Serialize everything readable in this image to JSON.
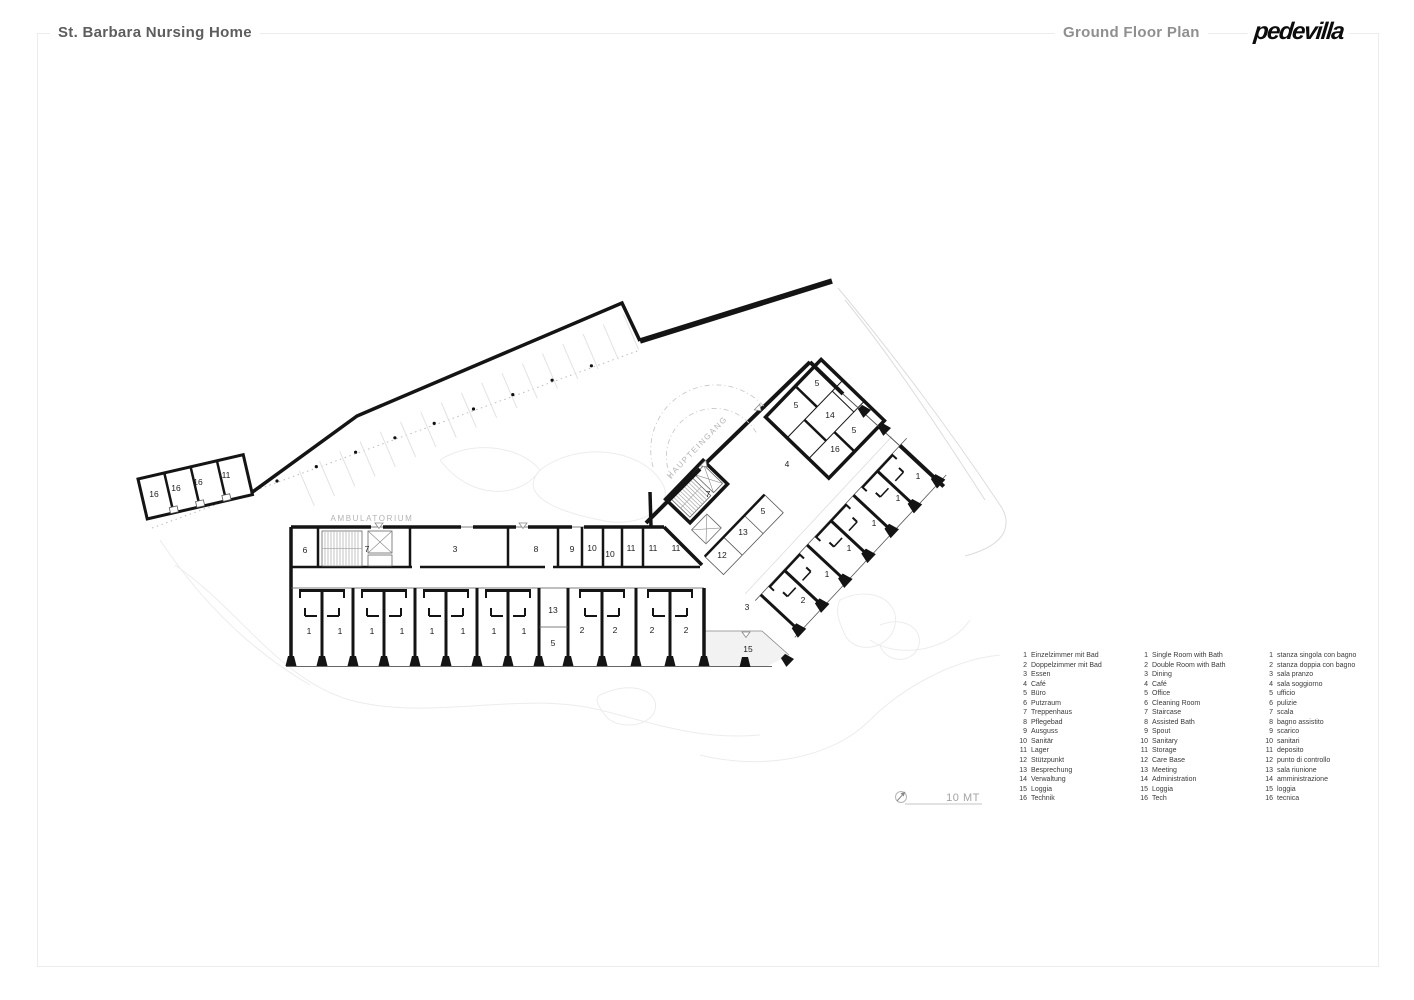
{
  "header": {
    "project_title": "St. Barbara Nursing Home",
    "sheet_title": "Ground Floor Plan",
    "logo_text": "pedevilla"
  },
  "icons": {
    "north_arrow": "compass-north-arrow-icon"
  },
  "colors": {
    "wall": "#141414",
    "annotation_gray": "#b3b3b3",
    "site_gray": "#ececec"
  },
  "plan": {
    "labels": [
      {
        "t": "16",
        "x": 154,
        "y": 497
      },
      {
        "t": "16",
        "x": 176,
        "y": 491
      },
      {
        "t": "16",
        "x": 198,
        "y": 485
      },
      {
        "t": "11",
        "x": 226,
        "y": 478
      },
      {
        "t": "6",
        "x": 305,
        "y": 553
      },
      {
        "t": "7",
        "x": 367,
        "y": 552
      },
      {
        "t": "3",
        "x": 455,
        "y": 552
      },
      {
        "t": "8",
        "x": 536,
        "y": 552
      },
      {
        "t": "9",
        "x": 572,
        "y": 552
      },
      {
        "t": "10",
        "x": 592,
        "y": 551
      },
      {
        "t": "10",
        "x": 610,
        "y": 557
      },
      {
        "t": "11",
        "x": 631,
        "y": 551
      },
      {
        "t": "11",
        "x": 653,
        "y": 551
      },
      {
        "t": "11",
        "x": 676,
        "y": 551
      },
      {
        "t": "7",
        "x": 708,
        "y": 497
      },
      {
        "t": "5",
        "x": 763,
        "y": 514
      },
      {
        "t": "13",
        "x": 743,
        "y": 535
      },
      {
        "t": "12",
        "x": 722,
        "y": 558
      },
      {
        "t": "1",
        "x": 309,
        "y": 634
      },
      {
        "t": "1",
        "x": 340,
        "y": 634
      },
      {
        "t": "1",
        "x": 372,
        "y": 634
      },
      {
        "t": "1",
        "x": 402,
        "y": 634
      },
      {
        "t": "1",
        "x": 432,
        "y": 634
      },
      {
        "t": "1",
        "x": 463,
        "y": 634
      },
      {
        "t": "1",
        "x": 494,
        "y": 634
      },
      {
        "t": "1",
        "x": 524,
        "y": 634
      },
      {
        "t": "13",
        "x": 553,
        "y": 613
      },
      {
        "t": "5",
        "x": 553,
        "y": 646
      },
      {
        "t": "2",
        "x": 582,
        "y": 633
      },
      {
        "t": "2",
        "x": 615,
        "y": 633
      },
      {
        "t": "2",
        "x": 652,
        "y": 633
      },
      {
        "t": "2",
        "x": 686,
        "y": 633
      },
      {
        "t": "3",
        "x": 747,
        "y": 610
      },
      {
        "t": "15",
        "x": 748,
        "y": 652
      },
      {
        "t": "5",
        "x": 817,
        "y": 386
      },
      {
        "t": "5",
        "x": 796,
        "y": 408
      },
      {
        "t": "14",
        "x": 830,
        "y": 418
      },
      {
        "t": "5",
        "x": 854,
        "y": 433
      },
      {
        "t": "16",
        "x": 835,
        "y": 452
      },
      {
        "t": "4",
        "x": 787,
        "y": 467
      },
      {
        "t": "1",
        "x": 918,
        "y": 479
      },
      {
        "t": "1",
        "x": 898,
        "y": 501
      },
      {
        "t": "1",
        "x": 874,
        "y": 526
      },
      {
        "t": "1",
        "x": 849,
        "y": 551
      },
      {
        "t": "1",
        "x": 827,
        "y": 577
      },
      {
        "t": "2",
        "x": 803,
        "y": 603
      },
      {
        "t": "AMBULATORIUM",
        "x": 372,
        "y": 521,
        "cls": "annot"
      },
      {
        "t": "HAUPTEINGANG",
        "x": 699,
        "y": 449,
        "r": -46,
        "cls": "annot"
      },
      {
        "t": "10 MT",
        "x": 963,
        "y": 801,
        "cls": "scale-label"
      }
    ]
  },
  "legend": {
    "columns": [
      {
        "lang": "de",
        "items": [
          [
            1,
            "Einzelzimmer mit Bad"
          ],
          [
            2,
            "Doppelzimmer mit Bad"
          ],
          [
            3,
            "Essen"
          ],
          [
            4,
            "Café"
          ],
          [
            5,
            "Büro"
          ],
          [
            6,
            "Putzraum"
          ],
          [
            7,
            "Treppenhaus"
          ],
          [
            8,
            "Pflegebad"
          ],
          [
            9,
            "Ausguss"
          ],
          [
            10,
            "Sanitär"
          ],
          [
            11,
            "Lager"
          ],
          [
            12,
            "Stützpunkt"
          ],
          [
            13,
            "Besprechung"
          ],
          [
            14,
            "Verwaltung"
          ],
          [
            15,
            "Loggia"
          ],
          [
            16,
            "Technik"
          ]
        ]
      },
      {
        "lang": "en",
        "items": [
          [
            1,
            "Single Room with Bath"
          ],
          [
            2,
            "Double Room with Bath"
          ],
          [
            3,
            "Dining"
          ],
          [
            4,
            "Café"
          ],
          [
            5,
            "Office"
          ],
          [
            6,
            "Cleaning Room"
          ],
          [
            7,
            "Staircase"
          ],
          [
            8,
            "Assisted Bath"
          ],
          [
            9,
            "Spout"
          ],
          [
            10,
            "Sanitary"
          ],
          [
            11,
            "Storage"
          ],
          [
            12,
            "Care Base"
          ],
          [
            13,
            "Meeting"
          ],
          [
            14,
            "Administration"
          ],
          [
            15,
            "Loggia"
          ],
          [
            16,
            "Tech"
          ]
        ]
      },
      {
        "lang": "it",
        "items": [
          [
            1,
            "stanza singola con bagno"
          ],
          [
            2,
            "stanza doppia con bagno"
          ],
          [
            3,
            "sala pranzo"
          ],
          [
            4,
            "sala soggiorno"
          ],
          [
            5,
            "ufficio"
          ],
          [
            6,
            "pulizie"
          ],
          [
            7,
            "scala"
          ],
          [
            8,
            "bagno assistito"
          ],
          [
            9,
            "scarico"
          ],
          [
            10,
            "sanitari"
          ],
          [
            11,
            "deposito"
          ],
          [
            12,
            "punto di controllo"
          ],
          [
            13,
            "sala riunione"
          ],
          [
            14,
            "amministrazione"
          ],
          [
            15,
            "loggia"
          ],
          [
            16,
            "tecnica"
          ]
        ]
      }
    ]
  }
}
